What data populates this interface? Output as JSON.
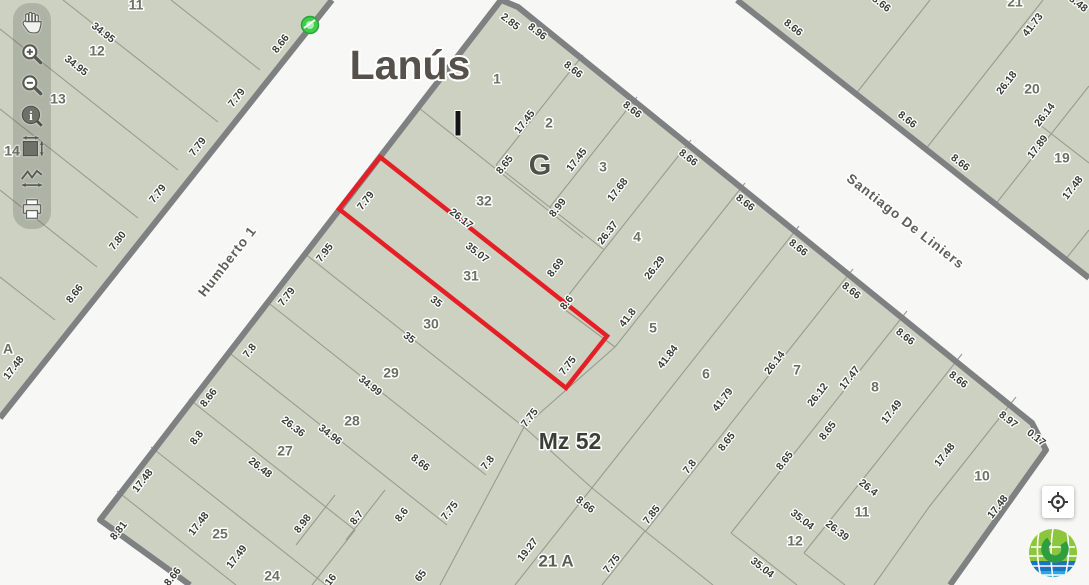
{
  "app": {
    "city_title": "Lanús",
    "block_label": "Mz 52"
  },
  "toolbar": {
    "tools": [
      {
        "name": "pan",
        "icon": "hand-icon"
      },
      {
        "name": "zoom-in",
        "icon": "zoom-in-icon"
      },
      {
        "name": "zoom-out",
        "icon": "zoom-out-icon"
      },
      {
        "name": "identify",
        "icon": "info-icon"
      },
      {
        "name": "full-extent",
        "icon": "extent-icon"
      },
      {
        "name": "measure",
        "icon": "measure-icon"
      },
      {
        "name": "print",
        "icon": "print-icon"
      }
    ]
  },
  "map": {
    "colors": {
      "block_fill": "#ccd1c2",
      "street": "#f7f7f5",
      "border": "#7e8082",
      "parcel_line": "#999b8f",
      "red_outline": "#e41f25",
      "marker_green": "#3ecf4a"
    },
    "streets": [
      {
        "name": "Humberto 1",
        "x": 228,
        "y": 262,
        "rot": -52
      },
      {
        "name": "Santiago De Liniers",
        "x": 905,
        "y": 222,
        "rot": 38
      }
    ],
    "section_letters": [
      {
        "t": "I",
        "x": 458,
        "y": 126,
        "r": 0,
        "c": "letterI"
      },
      {
        "t": "G",
        "x": 540,
        "y": 167,
        "r": 0,
        "c": "letterG"
      }
    ],
    "marker": {
      "x": 310,
      "y": 25
    },
    "red_parcel": {
      "points": "380,157 339,209 566,388 607,336",
      "number": "31"
    },
    "blocks": [
      {
        "name": "block-mz52",
        "fill_points": "190,585 100,520 501,0 518,7 1032,423 1046,450 950,585",
        "border_path": "M190,585 L100,520 L501,0 L518,7 L1032,423 L1046,450 L950,585",
        "lines": [
          583,
          55,
          496,
          165,
          637,
          97,
          550,
          207,
          691,
          140,
          603,
          251,
          603,
          251,
          560,
          306,
          745,
          183,
          615,
          347,
          615,
          347,
          524,
          427,
          799,
          226,
          591,
          489,
          853,
          269,
          645,
          532,
          907,
          311,
          777,
          475,
          962,
          354,
          875,
          464,
          1016,
          397,
          929,
          507,
          496,
          165,
          603,
          249,
          560,
          306,
          615,
          347,
          419,
          108,
          583,
          238,
          304,
          253,
          524,
          427,
          266,
          301,
          486,
          475,
          227,
          351,
          447,
          525,
          189,
          399,
          355,
          530,
          151,
          447,
          326,
          585,
          117,
          491,
          236,
          585,
          355,
          530,
          312,
          585,
          524,
          427,
          440,
          585,
          524,
          427,
          592,
          488,
          591,
          489,
          515,
          585,
          592,
          488,
          645,
          531,
          645,
          531,
          602,
          585,
          645,
          531,
          713,
          585,
          777,
          475,
          731,
          533,
          731,
          533,
          797,
          585,
          875,
          464,
          804,
          553,
          804,
          553,
          845,
          585,
          929,
          507,
          874,
          585,
          335,
          495,
          296,
          545,
          385,
          490,
          346,
          540
        ]
      },
      {
        "name": "block-northwest",
        "fill_points": "332,0 0,418 0,0",
        "border_path": "M332,0 L0,418",
        "lines": [
          260,
          70,
          171,
          0,
          218,
          122,
          63,
          0,
          178,
          170,
          0,
          29,
          138,
          218,
          0,
          109,
          97,
          267,
          0,
          190,
          55,
          320,
          0,
          277
        ]
      },
      {
        "name": "block-northeast",
        "fill_points": "737,0 1089,278 1089,0",
        "border_path": "M737,0 L1089,278",
        "lines": [
          855,
          95,
          930,
          0,
          925,
          150,
          1043,
          0,
          995,
          205,
          1089,
          86,
          1065,
          260,
          1089,
          230,
          1040,
          125,
          1089,
          163
        ]
      }
    ],
    "labels": [
      {
        "t": "11",
        "x": 136,
        "y": 6,
        "r": 0,
        "c": "parcel"
      },
      {
        "t": "34.95",
        "x": 103,
        "y": 33,
        "r": 38,
        "c": "dim"
      },
      {
        "t": "12",
        "x": 97,
        "y": 52,
        "r": 0,
        "c": "parcel"
      },
      {
        "t": "34.95",
        "x": 76,
        "y": 66,
        "r": 38,
        "c": "dim"
      },
      {
        "t": "13",
        "x": 58,
        "y": 100,
        "r": 0,
        "c": "parcel"
      },
      {
        "t": "14",
        "x": 12,
        "y": 152,
        "r": 0,
        "c": "parcel"
      },
      {
        "t": "A",
        "x": 8,
        "y": 350,
        "r": 0,
        "c": "parcel"
      },
      {
        "t": "8.66",
        "x": 281,
        "y": 44,
        "r": -52,
        "c": "dim"
      },
      {
        "t": "7.79",
        "x": 237,
        "y": 98,
        "r": -52,
        "c": "dim"
      },
      {
        "t": "7.79",
        "x": 198,
        "y": 147,
        "r": -52,
        "c": "dim"
      },
      {
        "t": "7.79",
        "x": 158,
        "y": 194,
        "r": -52,
        "c": "dim"
      },
      {
        "t": "7.80",
        "x": 118,
        "y": 241,
        "r": -52,
        "c": "dim"
      },
      {
        "t": "8.66",
        "x": 75,
        "y": 294,
        "r": -52,
        "c": "dim"
      },
      {
        "t": "17.48",
        "x": 14,
        "y": 368,
        "r": -52,
        "c": "dim"
      },
      {
        "t": "21",
        "x": 1015,
        "y": 3,
        "r": 0,
        "c": "parcel"
      },
      {
        "t": "8.48",
        "x": 1078,
        "y": 4,
        "r": 38,
        "c": "dim"
      },
      {
        "t": "41.73",
        "x": 1033,
        "y": 25,
        "r": -52,
        "c": "dim"
      },
      {
        "t": "26.18",
        "x": 1007,
        "y": 83,
        "r": -52,
        "c": "dim"
      },
      {
        "t": "20",
        "x": 1032,
        "y": 90,
        "r": 0,
        "c": "parcel"
      },
      {
        "t": "26.14",
        "x": 1045,
        "y": 115,
        "r": -52,
        "c": "dim"
      },
      {
        "t": "17.89",
        "x": 1038,
        "y": 147,
        "r": -52,
        "c": "dim"
      },
      {
        "t": "19",
        "x": 1062,
        "y": 159,
        "r": 0,
        "c": "parcel"
      },
      {
        "t": "17.48",
        "x": 1073,
        "y": 188,
        "r": -52,
        "c": "dim"
      },
      {
        "t": "8.66",
        "x": 793,
        "y": 28,
        "r": 38,
        "c": "dim"
      },
      {
        "t": "8.66",
        "x": 881,
        "y": 4,
        "r": 38,
        "c": "dim"
      },
      {
        "t": "8.66",
        "x": 907,
        "y": 120,
        "r": 38,
        "c": "dim"
      },
      {
        "t": "8.66",
        "x": 960,
        "y": 163,
        "r": 38,
        "c": "dim"
      },
      {
        "t": "2.85",
        "x": 510,
        "y": 22,
        "r": 38,
        "c": "dim"
      },
      {
        "t": "8.96",
        "x": 537,
        "y": 32,
        "r": 38,
        "c": "dim"
      },
      {
        "t": "8.66",
        "x": 573,
        "y": 70,
        "r": 38,
        "c": "dim"
      },
      {
        "t": "8.66",
        "x": 632,
        "y": 110,
        "r": 38,
        "c": "dim"
      },
      {
        "t": "8.66",
        "x": 688,
        "y": 158,
        "r": 38,
        "c": "dim"
      },
      {
        "t": "8.66",
        "x": 745,
        "y": 203,
        "r": 38,
        "c": "dim"
      },
      {
        "t": "8.66",
        "x": 798,
        "y": 248,
        "r": 38,
        "c": "dim"
      },
      {
        "t": "8.66",
        "x": 851,
        "y": 291,
        "r": 38,
        "c": "dim"
      },
      {
        "t": "8.66",
        "x": 905,
        "y": 337,
        "r": 38,
        "c": "dim"
      },
      {
        "t": "8.66",
        "x": 958,
        "y": 380,
        "r": 38,
        "c": "dim"
      },
      {
        "t": "8.97",
        "x": 1008,
        "y": 420,
        "r": 38,
        "c": "dim"
      },
      {
        "t": "0.17",
        "x": 1036,
        "y": 438,
        "r": 38,
        "c": "dim"
      },
      {
        "t": "1",
        "x": 497,
        "y": 80,
        "r": 0,
        "c": "parcel"
      },
      {
        "t": "2",
        "x": 549,
        "y": 124,
        "r": 0,
        "c": "parcel"
      },
      {
        "t": "3",
        "x": 603,
        "y": 168,
        "r": 0,
        "c": "parcel"
      },
      {
        "t": "17.45",
        "x": 525,
        "y": 122,
        "r": -52,
        "c": "dim"
      },
      {
        "t": "17.45",
        "x": 577,
        "y": 160,
        "r": -52,
        "c": "dim"
      },
      {
        "t": "17.68",
        "x": 618,
        "y": 190,
        "r": -52,
        "c": "dim"
      },
      {
        "t": "8.65",
        "x": 505,
        "y": 165,
        "r": -52,
        "c": "dim"
      },
      {
        "t": "8.99",
        "x": 558,
        "y": 208,
        "r": -52,
        "c": "dim"
      },
      {
        "t": "26.37",
        "x": 608,
        "y": 233,
        "r": -52,
        "c": "dim"
      },
      {
        "t": "8.69",
        "x": 556,
        "y": 268,
        "r": -52,
        "c": "dim"
      },
      {
        "t": "8.6",
        "x": 567,
        "y": 303,
        "r": -52,
        "c": "dim"
      },
      {
        "t": "4",
        "x": 637,
        "y": 238,
        "r": 0,
        "c": "parcel"
      },
      {
        "t": "26.29",
        "x": 655,
        "y": 268,
        "r": -52,
        "c": "dim"
      },
      {
        "t": "41.8",
        "x": 628,
        "y": 318,
        "r": -52,
        "c": "dim"
      },
      {
        "t": "5",
        "x": 653,
        "y": 329,
        "r": 0,
        "c": "parcel"
      },
      {
        "t": "41.84",
        "x": 668,
        "y": 357,
        "r": -52,
        "c": "dim"
      },
      {
        "t": "6",
        "x": 706,
        "y": 375,
        "r": 0,
        "c": "parcel"
      },
      {
        "t": "41.79",
        "x": 723,
        "y": 400,
        "r": -52,
        "c": "dim"
      },
      {
        "t": "26.14",
        "x": 775,
        "y": 363,
        "r": -52,
        "c": "dim"
      },
      {
        "t": "7",
        "x": 797,
        "y": 371,
        "r": 0,
        "c": "parcel"
      },
      {
        "t": "26.12",
        "x": 818,
        "y": 395,
        "r": -52,
        "c": "dim"
      },
      {
        "t": "17.47",
        "x": 850,
        "y": 378,
        "r": -52,
        "c": "dim"
      },
      {
        "t": "8",
        "x": 875,
        "y": 388,
        "r": 0,
        "c": "parcel"
      },
      {
        "t": "17.49",
        "x": 892,
        "y": 412,
        "r": -52,
        "c": "dim"
      },
      {
        "t": "7.79",
        "x": 366,
        "y": 201,
        "r": -52,
        "c": "dim"
      },
      {
        "t": "26.17",
        "x": 461,
        "y": 219,
        "r": 38,
        "c": "dim"
      },
      {
        "t": "32",
        "x": 484,
        "y": 202,
        "r": 0,
        "c": "parcel"
      },
      {
        "t": "35.07",
        "x": 477,
        "y": 253,
        "r": 38,
        "c": "dim"
      },
      {
        "t": "31",
        "x": 471,
        "y": 277,
        "r": 0,
        "c": "parcel"
      },
      {
        "t": "7.75",
        "x": 568,
        "y": 366,
        "r": -52,
        "c": "dim"
      },
      {
        "t": "7.95",
        "x": 325,
        "y": 253,
        "r": -52,
        "c": "dim"
      },
      {
        "t": "35",
        "x": 436,
        "y": 302,
        "r": 38,
        "c": "dim"
      },
      {
        "t": "30",
        "x": 431,
        "y": 325,
        "r": 0,
        "c": "parcel"
      },
      {
        "t": "35",
        "x": 409,
        "y": 338,
        "r": 38,
        "c": "dim"
      },
      {
        "t": "7.79",
        "x": 287,
        "y": 297,
        "r": -52,
        "c": "dim"
      },
      {
        "t": "29",
        "x": 391,
        "y": 374,
        "r": 0,
        "c": "parcel"
      },
      {
        "t": "34.99",
        "x": 370,
        "y": 386,
        "r": 38,
        "c": "dim"
      },
      {
        "t": "7.8",
        "x": 250,
        "y": 351,
        "r": -52,
        "c": "dim"
      },
      {
        "t": "28",
        "x": 352,
        "y": 422,
        "r": 0,
        "c": "parcel"
      },
      {
        "t": "34.96",
        "x": 330,
        "y": 435,
        "r": 38,
        "c": "dim"
      },
      {
        "t": "26.36",
        "x": 293,
        "y": 427,
        "r": 38,
        "c": "dim"
      },
      {
        "t": "8.66",
        "x": 209,
        "y": 398,
        "r": -52,
        "c": "dim"
      },
      {
        "t": "27",
        "x": 285,
        "y": 452,
        "r": 0,
        "c": "parcel"
      },
      {
        "t": "26.48",
        "x": 260,
        "y": 468,
        "r": 38,
        "c": "dim"
      },
      {
        "t": "8.8",
        "x": 197,
        "y": 438,
        "r": -52,
        "c": "dim"
      },
      {
        "t": "17.48",
        "x": 143,
        "y": 481,
        "r": -52,
        "c": "dim"
      },
      {
        "t": "25",
        "x": 220,
        "y": 535,
        "r": 0,
        "c": "parcel"
      },
      {
        "t": "17.48",
        "x": 199,
        "y": 524,
        "r": -52,
        "c": "dim"
      },
      {
        "t": "17.49",
        "x": 237,
        "y": 557,
        "r": -52,
        "c": "dim"
      },
      {
        "t": "8.81",
        "x": 119,
        "y": 531,
        "r": -52,
        "c": "dim"
      },
      {
        "t": "8.66",
        "x": 173,
        "y": 577,
        "r": -52,
        "c": "dim"
      },
      {
        "t": "24",
        "x": 272,
        "y": 577,
        "r": 0,
        "c": "parcel"
      },
      {
        "t": "16",
        "x": 331,
        "y": 580,
        "r": -52,
        "c": "dim"
      },
      {
        "t": "65",
        "x": 421,
        "y": 576,
        "r": -52,
        "c": "dim"
      },
      {
        "t": "8.98",
        "x": 303,
        "y": 524,
        "r": -52,
        "c": "dim"
      },
      {
        "t": "8.7",
        "x": 357,
        "y": 518,
        "r": -52,
        "c": "dim"
      },
      {
        "t": "8.6",
        "x": 402,
        "y": 515,
        "r": -52,
        "c": "dim"
      },
      {
        "t": "7.75",
        "x": 450,
        "y": 511,
        "r": -52,
        "c": "dim"
      },
      {
        "t": "8.66",
        "x": 420,
        "y": 463,
        "r": 38,
        "c": "dim"
      },
      {
        "t": "7.75",
        "x": 530,
        "y": 418,
        "r": -52,
        "c": "dim"
      },
      {
        "t": "7.8",
        "x": 488,
        "y": 463,
        "r": -52,
        "c": "dim"
      },
      {
        "t": "19.27",
        "x": 528,
        "y": 550,
        "r": -52,
        "c": "dim"
      },
      {
        "t": "21 A",
        "x": 556,
        "y": 562,
        "r": 0,
        "c": "plg"
      },
      {
        "t": "8.66",
        "x": 585,
        "y": 505,
        "r": 38,
        "c": "dim"
      },
      {
        "t": "7.85",
        "x": 652,
        "y": 515,
        "r": -52,
        "c": "dim"
      },
      {
        "t": "7.75",
        "x": 612,
        "y": 564,
        "r": -52,
        "c": "dim"
      },
      {
        "t": "7.8",
        "x": 690,
        "y": 467,
        "r": -52,
        "c": "dim"
      },
      {
        "t": "8.65",
        "x": 727,
        "y": 442,
        "r": -52,
        "c": "dim"
      },
      {
        "t": "8.65",
        "x": 785,
        "y": 461,
        "r": -52,
        "c": "dim"
      },
      {
        "t": "8.65",
        "x": 828,
        "y": 431,
        "r": -52,
        "c": "dim"
      },
      {
        "t": "26.4",
        "x": 868,
        "y": 488,
        "r": 38,
        "c": "dim"
      },
      {
        "t": "26.39",
        "x": 837,
        "y": 531,
        "r": 38,
        "c": "dim"
      },
      {
        "t": "35.04",
        "x": 802,
        "y": 520,
        "r": 38,
        "c": "dim"
      },
      {
        "t": "35.04",
        "x": 762,
        "y": 568,
        "r": 38,
        "c": "dim"
      },
      {
        "t": "17.48",
        "x": 945,
        "y": 455,
        "r": -52,
        "c": "dim"
      },
      {
        "t": "10",
        "x": 982,
        "y": 477,
        "r": 0,
        "c": "parcel"
      },
      {
        "t": "17.48",
        "x": 998,
        "y": 507,
        "r": -52,
        "c": "dim"
      },
      {
        "t": "11",
        "x": 862,
        "y": 513,
        "r": 0,
        "c": "parcel"
      },
      {
        "t": "12",
        "x": 795,
        "y": 542,
        "r": 0,
        "c": "parcel"
      },
      {
        "t": "Lanús",
        "x": 410,
        "y": 68,
        "r": 0,
        "c": "title"
      },
      {
        "t": "Mz 52",
        "x": 570,
        "y": 443,
        "r": 0,
        "c": "mz"
      }
    ]
  },
  "controls": {
    "locate": "locate-button"
  },
  "logo": {
    "colors": {
      "light_green": "#8cc63e",
      "dark_green": "#2f9e41",
      "blue": "#1b75bc",
      "light_blue": "#27aae1",
      "white": "#ffffff"
    }
  }
}
